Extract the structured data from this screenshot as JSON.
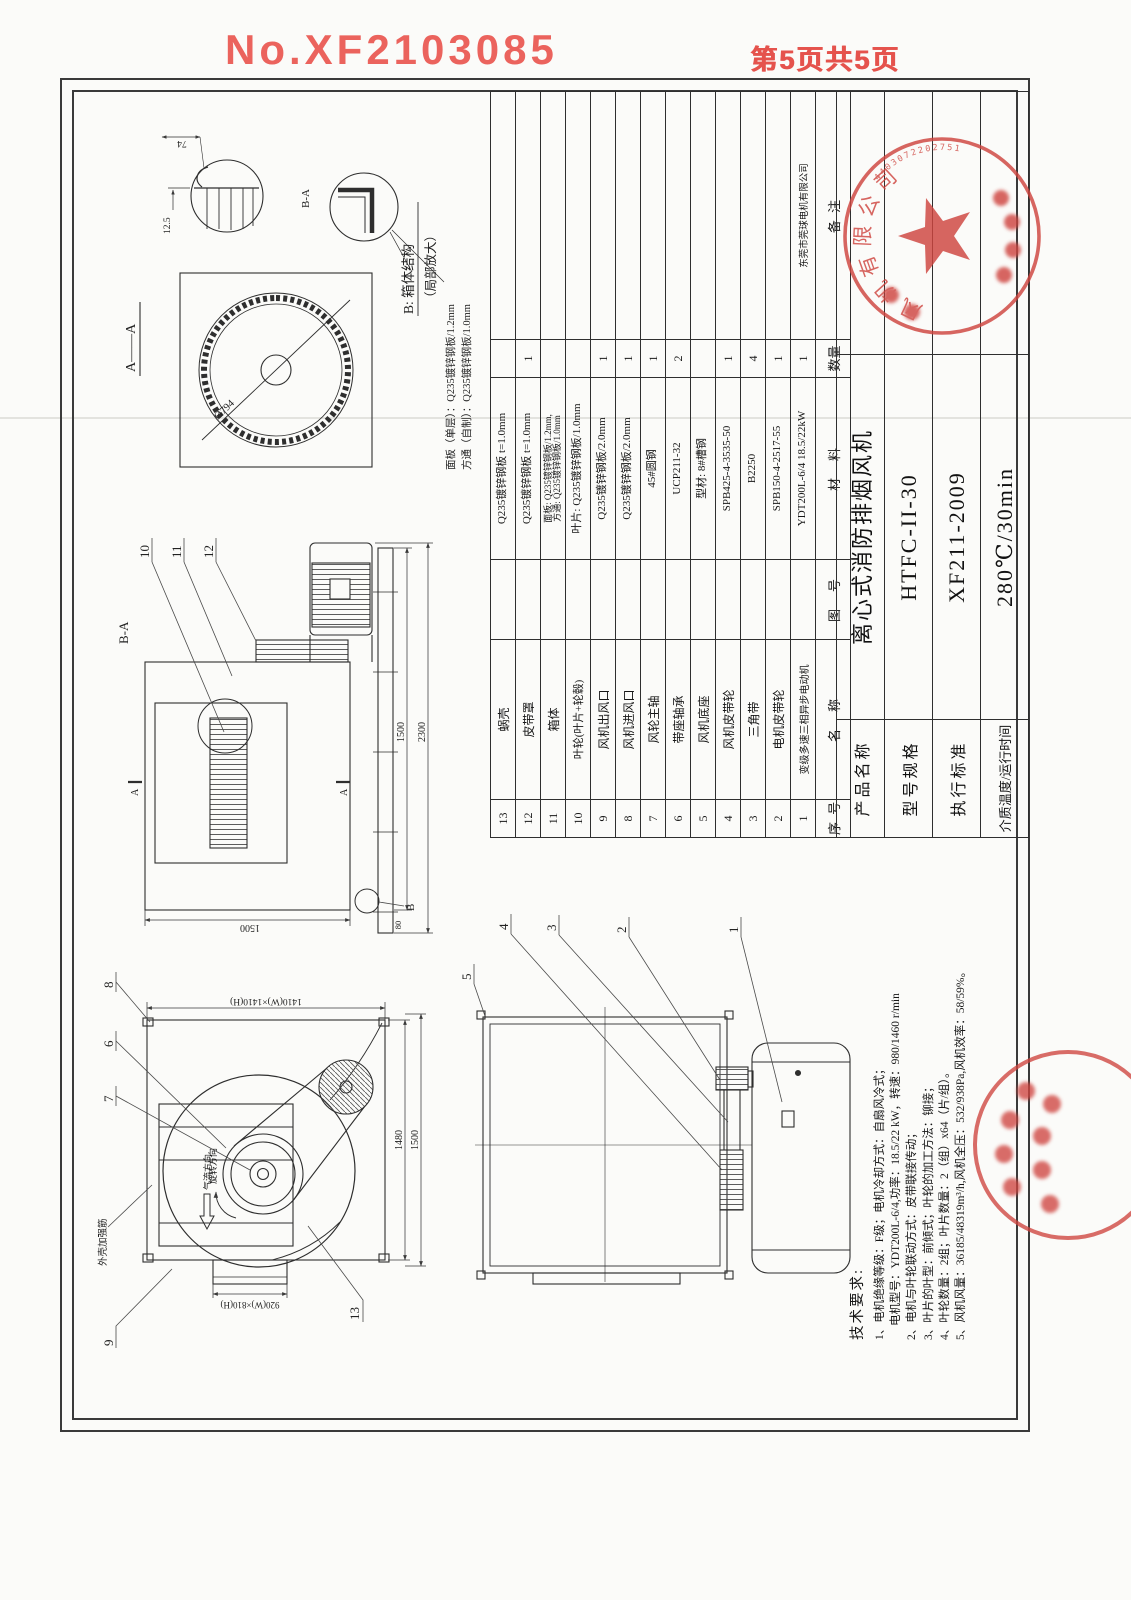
{
  "page": {
    "doc_no": "No.XF2103085",
    "page_label": "第5页共5页"
  },
  "aa_view": {
    "title": "A——A",
    "diameter": "Ø794",
    "dim_74": "74",
    "dim_12_5": "12.5",
    "blade_detail_label": "B-A"
  },
  "detail_b": {
    "title_line1": "B: 箱体结构",
    "title_line2": "（局部放大）",
    "panel_note": "面板（单层）：Q235镀锌钢板/1.2mm",
    "tube_note": "方通（自制）：Q235镀锌钢板/1.0mm"
  },
  "front_view": {
    "callout_9": "9",
    "callout_7": "7",
    "callout_6": "6",
    "callout_8": "8",
    "callout_13": "13",
    "rib_label": "外壳加强筋",
    "airflow_label": "气流方向",
    "rotation_label": "旋转方向",
    "dim_flange": "1410(W)×1410(H)",
    "dim_outlet": "920(W)×810(H)",
    "dim_1480": "1480",
    "dim_1500": "1500"
  },
  "section_view": {
    "title": "B-A",
    "mark_a": "A",
    "mark_b": "B",
    "callout_10": "10",
    "callout_11": "11",
    "callout_12": "12",
    "dim_height": "1500",
    "dim_box": "1500",
    "dim_total": "2300",
    "dim_80": "80"
  },
  "side_view": {
    "callout_1": "1",
    "callout_2": "2",
    "callout_3": "3",
    "callout_4": "4",
    "callout_5": "5"
  },
  "notes": {
    "title": "技术要求:",
    "l1": "1、电机绝缘等级：F级；电机冷却方式：自扇风冷式；",
    "l1b": "电机型号：YDT200L-6/4,功率：18.5/22 kW，转速：980/1460 r/min",
    "l2": "2、电机与叶轮联动方式：皮带联接传动；",
    "l3": "3、叶片的叶型：前倾式；叶轮的加工方法：铆接；",
    "l4": "4、叶轮数量：2组；叶片数量：2（组）x64（片/组）。",
    "l5": "5、风机风量：36185/48319m³/h,风机全压：532/938Pa,风机效率：58/59%。"
  },
  "parts_table": {
    "h_no": "序 号",
    "h_name": "名　称",
    "h_dwg": "图　号",
    "h_mat": "材　料",
    "h_qty": "数量",
    "h_rk": "备 注",
    "rows": [
      {
        "no": "13",
        "name": "蜗壳",
        "dwg": "",
        "mat": "Q235镀锌钢板 t=1.0mm",
        "qty": "",
        "rk": ""
      },
      {
        "no": "12",
        "name": "皮带罩",
        "dwg": "",
        "mat": "Q235镀锌钢板 t=1.0mm",
        "qty": "1",
        "rk": ""
      },
      {
        "no": "11",
        "name": "箱体",
        "dwg": "",
        "mat": "面板: Q235镀锌钢板/1.2mm,\n方通: Q235镀锌钢板/1.0mm",
        "qty": "",
        "rk": ""
      },
      {
        "no": "10",
        "name": "叶轮(叶片+轮毂)",
        "dwg": "",
        "mat": "叶片: Q235镀锌钢板/1.0mm",
        "qty": "",
        "rk": ""
      },
      {
        "no": "9",
        "name": "风机出风口",
        "dwg": "",
        "mat": "Q235镀锌钢板/2.0mm",
        "qty": "1",
        "rk": ""
      },
      {
        "no": "8",
        "name": "风机进风口",
        "dwg": "",
        "mat": "Q235镀锌钢板/2.0mm",
        "qty": "1",
        "rk": ""
      },
      {
        "no": "7",
        "name": "风轮主轴",
        "dwg": "",
        "mat": "45#圆钢",
        "qty": "1",
        "rk": ""
      },
      {
        "no": "6",
        "name": "带座轴承",
        "dwg": "",
        "mat": "UCP211-32",
        "qty": "2",
        "rk": ""
      },
      {
        "no": "5",
        "name": "风机底座",
        "dwg": "",
        "mat": "型材: 8#槽钢",
        "qty": "",
        "rk": ""
      },
      {
        "no": "4",
        "name": "风机皮带轮",
        "dwg": "",
        "mat": "SPB425-4-3535-50",
        "qty": "1",
        "rk": ""
      },
      {
        "no": "3",
        "name": "三角带",
        "dwg": "",
        "mat": "B2250",
        "qty": "4",
        "rk": ""
      },
      {
        "no": "2",
        "name": "电机皮带轮",
        "dwg": "",
        "mat": "SPB150-4-2517-55",
        "qty": "1",
        "rk": ""
      },
      {
        "no": "1",
        "name": "变级多速三相异步电动机",
        "dwg": "",
        "mat": "YDT200L-6/4  18.5/22kW",
        "qty": "1",
        "rk": "东莞市莞球电机有限公司"
      }
    ]
  },
  "title_block": {
    "r1_label": "产品名称",
    "r1_value": "离心式消防排烟风机",
    "r2_label": "型号规格",
    "r2_value": "HTFC-II-30",
    "r3_label": "执行标准",
    "r3_value": "XF211-2009",
    "r4_label": "介质温度/运行时间",
    "r4_value": "280℃/30min"
  },
  "stamps": {
    "main_arc_text": "风机有限公司",
    "main_serial": "4403072202751"
  },
  "colors": {
    "stamp_red": "#cf453f",
    "header_red": "#ea5750",
    "line": "#2f2f2f"
  }
}
